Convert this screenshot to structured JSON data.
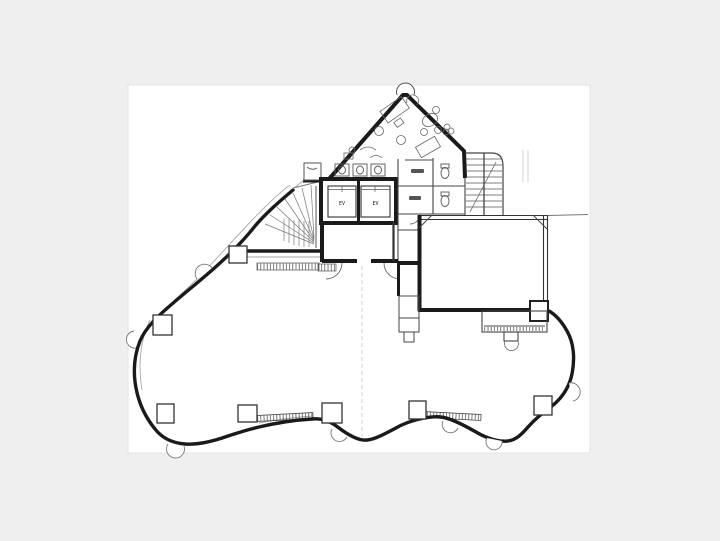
{
  "page": {
    "background_color": "#efefef",
    "scan_background_color": "#ffffff"
  },
  "floorplan": {
    "description_label": "architectural-floor-plan-scan",
    "elevators": [
      {
        "label": "EV"
      },
      {
        "label": "EV"
      }
    ],
    "colors": {
      "wall": "#1a1a1a",
      "partition": "#444444",
      "thin_detail": "#666666",
      "faint": "#aaaaaa"
    },
    "column_count": 7
  }
}
